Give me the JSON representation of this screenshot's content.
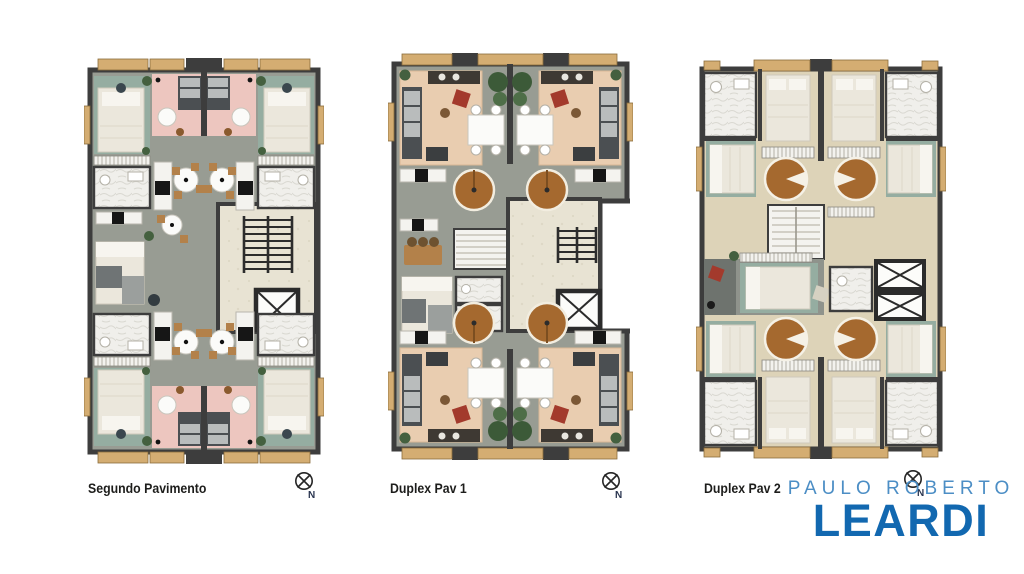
{
  "plans": [
    {
      "label": "Segundo Pavimento",
      "compass_label": "N"
    },
    {
      "label": "Duplex Pav 1",
      "compass_label": "N"
    },
    {
      "label": "Duplex Pav 2",
      "compass_label": "N"
    }
  ],
  "logo": {
    "top_line": "PAULO ROBERTO",
    "bottom_line": "LEARDI",
    "top_color": "#4c8ec5",
    "bottom_color": "#1268b0"
  },
  "colors": {
    "wall": "#3d3d3d",
    "floor_gray": "#989c93",
    "wood_floor": "#ddd3b8",
    "teal_rug": "#95ada1",
    "pink_room": "#edc6bf",
    "stairwell_beige": "#e8e3d3",
    "spiral_stair_wood": "#a5692f",
    "balcony_wood": "#d4ad72",
    "accent_red": "#a33a2c",
    "plant_green": "#44603f",
    "label_text": "#1d1d1b"
  }
}
